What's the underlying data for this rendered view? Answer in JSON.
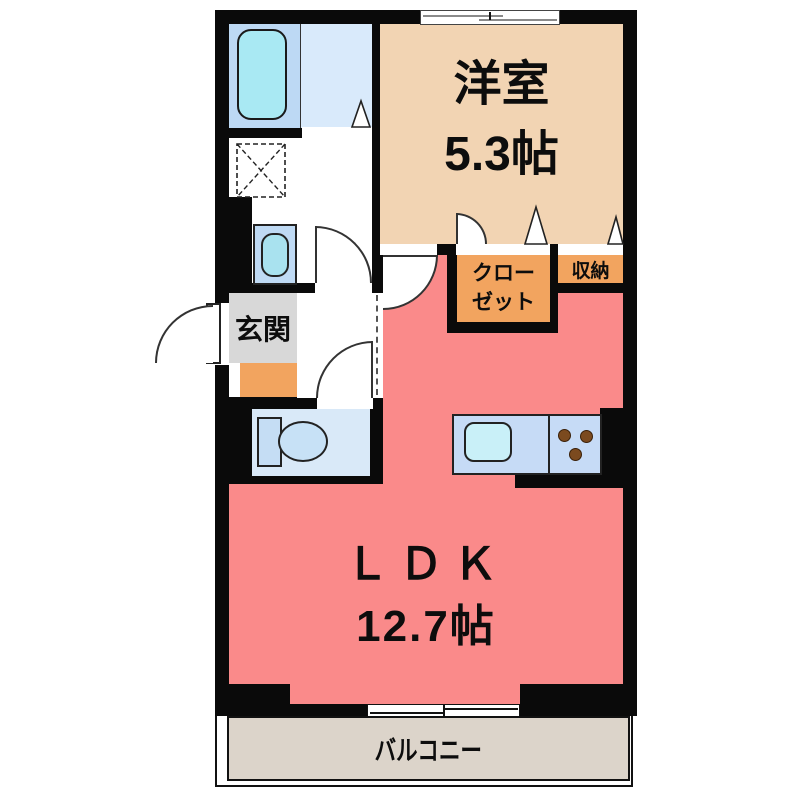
{
  "floorplan": {
    "western_room": {
      "label": "洋室",
      "area": "5.3帖"
    },
    "ldk": {
      "label": "ＬＤＫ",
      "area": "12.7帖"
    },
    "entrance": {
      "label": "玄関"
    },
    "closet": {
      "label_line1": "クロー",
      "label_line2": "ゼット"
    },
    "storage": {
      "label": "収納"
    },
    "balcony": {
      "label": "バルコニー"
    },
    "fixtures": {
      "bathtub": "bathtub",
      "washing_machine_pan": "washing-machine-pan",
      "vanity": "vanity-sink",
      "toilet": "toilet",
      "kitchen_sink": "kitchen-sink",
      "stove": "stove-burners",
      "top_window": "sliding-window",
      "balcony_window": "sliding-window",
      "doors": "hinged-and-folding-doors"
    },
    "colors": {
      "wall": "#0a0a0a",
      "ldk_floor": "#FA8A8A",
      "western_room_floor": "#F2D4B3",
      "closet_fill": "#F2A45F",
      "entrance_fill": "#D8D8D8",
      "entrance_mat": "#F2A45F",
      "bathroom_left": "#BDD9F4",
      "bathroom_right": "#D9EAFB",
      "bathtub_fill": "#A9E9F3",
      "toilet_floor": "#D9E9F8",
      "kitchen_counter": "#C6DBF6",
      "balcony_floor": "#DCD4CA"
    }
  }
}
